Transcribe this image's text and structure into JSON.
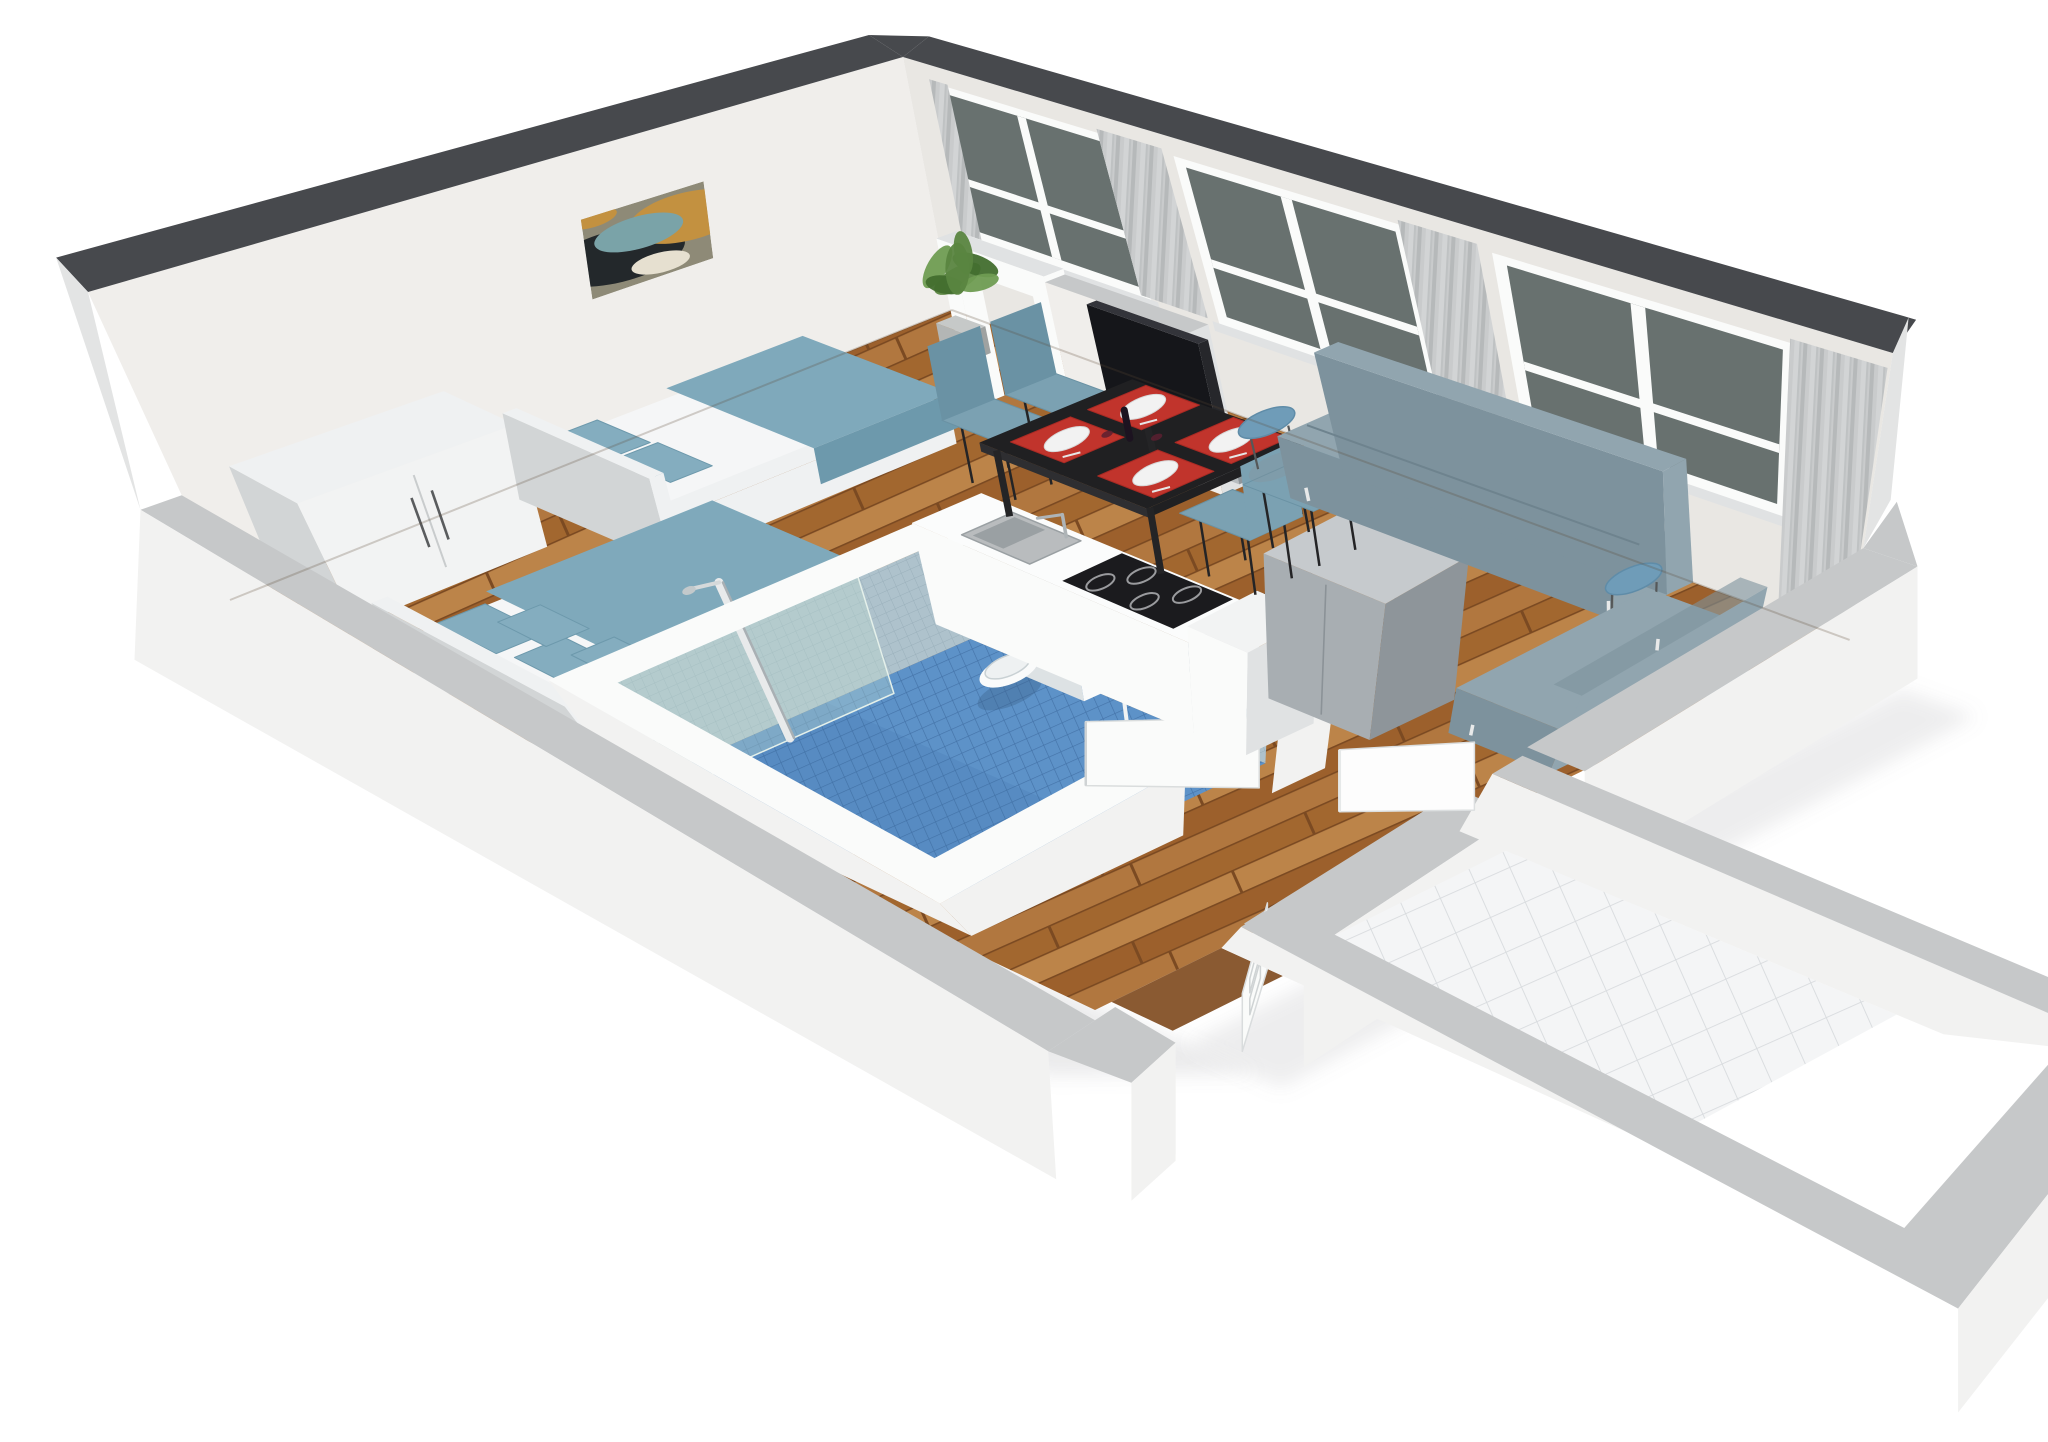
{
  "scene": {
    "kind": "3d-apartment-floorplan-render",
    "view": "isometric-cutaway-from-south-west-above",
    "background": "#ffffff"
  },
  "rooms": [
    {
      "name": "bedroom",
      "floor": "wood"
    },
    {
      "name": "bathroom",
      "floor": "blue-mosaic",
      "sunken": true
    },
    {
      "name": "kitchen",
      "floor": "wood"
    },
    {
      "name": "dining-area",
      "floor": "wood"
    },
    {
      "name": "living-room",
      "floor": "wood"
    },
    {
      "name": "entry-vestibule",
      "floor": "white-tile"
    }
  ],
  "items": [
    {
      "name": "abstract-painting",
      "room": "bedroom"
    },
    {
      "name": "wardrobe-sideboard",
      "room": "bedroom",
      "doors": 2
    },
    {
      "name": "single-bed",
      "room": "bedroom",
      "bedding": "blue-white"
    },
    {
      "name": "double-bed",
      "room": "bedroom",
      "bedding": "blue-white",
      "pillows": 4
    },
    {
      "name": "tv-partition-wall",
      "room": "living-room"
    },
    {
      "name": "open-doorway-frame",
      "room": "living-room"
    },
    {
      "name": "flat-tv",
      "room": "living-room"
    },
    {
      "name": "potted-plant",
      "room": "living-room"
    },
    {
      "name": "windows",
      "room": "living-room",
      "count": 3
    },
    {
      "name": "curtains",
      "room": "living-room",
      "count": 3
    },
    {
      "name": "sofa",
      "room": "living-room",
      "color": "gray-blue"
    },
    {
      "name": "daybed",
      "room": "living-room",
      "color": "gray-blue"
    },
    {
      "name": "round-side-table",
      "count": 2,
      "color": "blue"
    },
    {
      "name": "dining-table",
      "room": "dining-area",
      "color": "black",
      "settings": 4
    },
    {
      "name": "dining-chairs",
      "room": "dining-area",
      "count": 4,
      "color": "blue"
    },
    {
      "name": "red-placemats-with-plates",
      "count": 4
    },
    {
      "name": "kitchen-counter",
      "room": "kitchen",
      "appliances": [
        "sink",
        "cooktop"
      ]
    },
    {
      "name": "cooktop",
      "burners": 4
    },
    {
      "name": "refrigerator",
      "color": "gray"
    },
    {
      "name": "wall-hung-toilet",
      "room": "bathroom"
    },
    {
      "name": "wall-hung-sink",
      "room": "bathroom"
    },
    {
      "name": "shower-column",
      "room": "bathroom"
    },
    {
      "name": "shower-glass-panel",
      "room": "bathroom"
    },
    {
      "name": "bathroom-door",
      "state": "open"
    },
    {
      "name": "vestibule-door",
      "state": "open"
    },
    {
      "name": "entry-paneled-door",
      "state": "open"
    }
  ],
  "colors": {
    "bg": "#ffffff",
    "wall_top": "#47494d",
    "wall_face": "#f0eeeb",
    "wall_face2": "#e9e7e3",
    "wall_outer": "#f3f3f2",
    "wall_outer_shade": "#e3e4e4",
    "low_wall_top": "#c6c8c9",
    "low_wall_face": "#f2f2f1",
    "plank1": "#b1773f",
    "plank2": "#a2672f",
    "plank3": "#bc8449",
    "plank4": "#9c602c",
    "plank_seam": "#7b4a22",
    "threshold_wood": "#8a5a32",
    "bath_tile": "#5d92c8",
    "bath_tile_grid": "#4473a8",
    "bath_wall_tile": "#aec2cc",
    "bath_wall_grid": "#9ab0bb",
    "white_tile": "#f4f5f6",
    "white_tile_grid": "#d8dbde",
    "window_glass": "#68716f",
    "frame_white": "#fafbfa",
    "curtain_a": "#c9cbcc",
    "curtain_b": "#b6b9ba",
    "curtain_c": "#d2d4d5",
    "curtain_d": "#bfc2c3",
    "sofa": "#91a5af",
    "sofa_dark": "#7d929d",
    "sofa_seam": "#6e838e",
    "blanket": "#7fa9bb",
    "blanket_dark": "#6d99ac",
    "pillow": "#84adbf",
    "mattress": "#f5f6f7",
    "bedframe": "#eff1f2",
    "bedframe_shade": "#dcdfe1",
    "furn_white": "#f2f3f3",
    "furn_white_shade": "#e0e2e3",
    "furn_white_side": "#d2d5d6",
    "handle_dark": "#5a5c5e",
    "table_black": "#202022",
    "table_side": "#2e2e31",
    "table_leg": "#242426",
    "chair_blue": "#7ba1b2",
    "chair_dark": "#6a92a4",
    "placemat_red": "#c1342c",
    "placemat_dark": "#a82a24",
    "plate_white": "#f2f2f2",
    "round_table_top": "#6f9cb8",
    "round_table_rim": "#5f8ca8",
    "fridge_top": "#c6cacd",
    "fridge_front": "#a8aeb2",
    "fridge_side": "#8e959a",
    "cooktop": "#1b1b1e",
    "burner_ring": "#9a9b9e",
    "steel": "#b7bcbf",
    "tv_black": "#15161a",
    "plant_green": "#5a8540",
    "plant_dark": "#426e2e",
    "plant_light": "#6f9c52",
    "pot_gray": "#b3b6b5",
    "ceramic": "#fafbfb",
    "ceramic_shade": "#dde2e4",
    "art_bg": "#8e8a77",
    "art_dark": "#23282b",
    "art_gold": "#c39140",
    "art_teal": "#7aa3a8",
    "art_light": "#e6e0d0",
    "glass_pane": "#bcd9cf",
    "shadow": "rgba(140,142,146,0.35)"
  }
}
